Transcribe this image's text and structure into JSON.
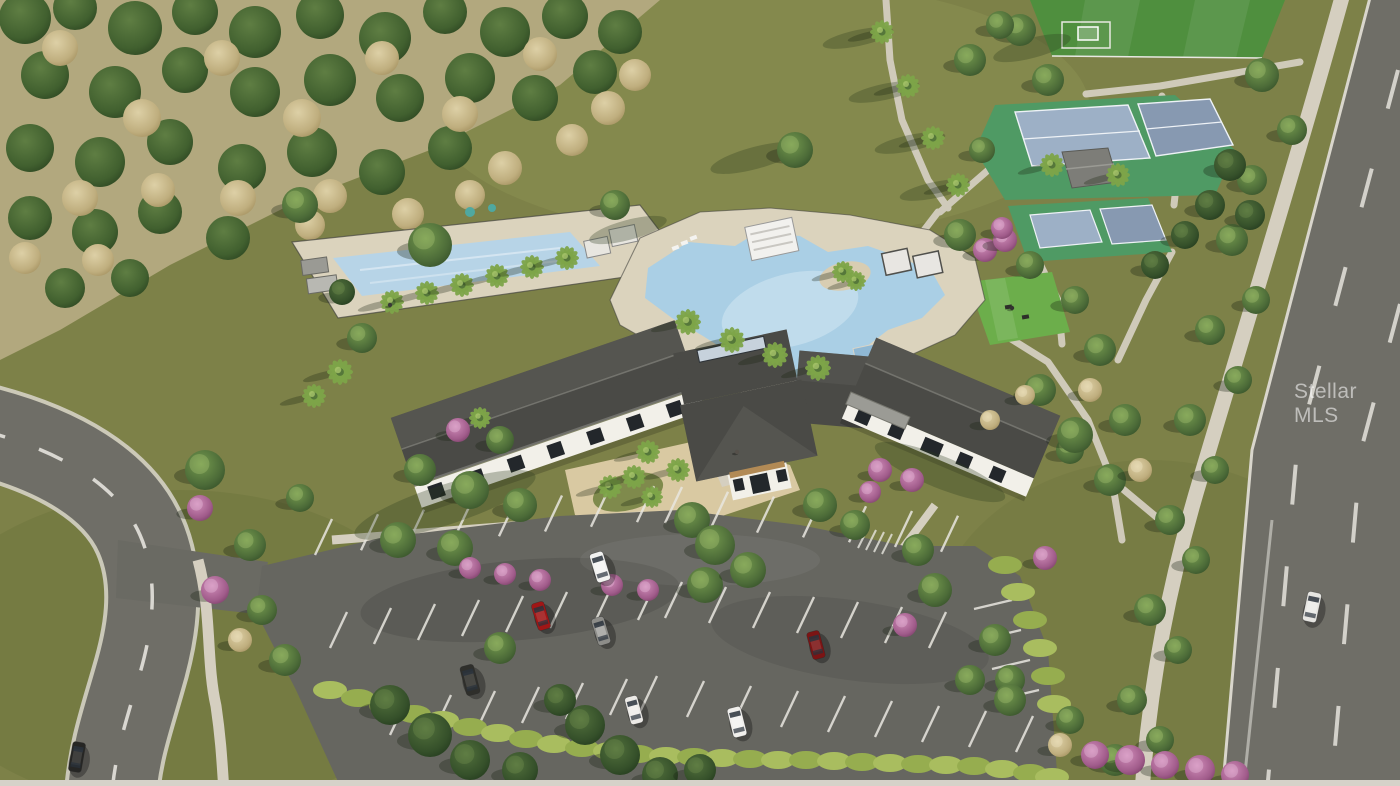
{
  "image": {
    "width": 1400,
    "height": 786,
    "kind": "aerial-3d-rendering",
    "subject": "community clubhouse amenity center with resort pool, lap pool, tennis and pickleball courts, event lawn, soccer field, parking lot and perimeter roads"
  },
  "watermark": {
    "text": "Stellar MLS",
    "color": "rgba(255,255,255,0.55)"
  },
  "palette": {
    "grassMeadow": "#7d8148",
    "grassLight": "#8b8f52",
    "grassDark": "#667039",
    "fieldGreen": "#4f8f3e",
    "lawnGreen": "#6cae4b",
    "courtGreen": "#4f9a64",
    "courtBlue": "#9db0c6",
    "courtBlueShade": "#8799b1",
    "scrubBase": "#b2a87e",
    "asphalt": "#666660",
    "roadAsphalt": "#6f6e67",
    "curb": "#d9d6cc",
    "concrete": "#d5cfc0",
    "pavers": "#d9c9a2",
    "deck": "#dbd3bd",
    "poolWater": "#aacfe5",
    "poolLight": "#cde3f0",
    "lapWater": "#b7d4e7",
    "roofDark": "#4a4a46",
    "roofLight": "#5f5f59",
    "ridgeLight": "#73736d",
    "wallWhite": "#f2f0e9",
    "windowDark": "#23272b",
    "stripeWhite": "#e9e7e0",
    "hedgeGreen": "#a9bd5f",
    "pinkBloom": "#b4679c",
    "bottomStrip": "#d6d2c9"
  },
  "scene": {
    "scrub": [
      [
        25,
        18,
        26,
        "sg"
      ],
      [
        75,
        8,
        22,
        "sg"
      ],
      [
        135,
        28,
        27,
        "sg"
      ],
      [
        195,
        12,
        23,
        "sg"
      ],
      [
        255,
        32,
        26,
        "sg"
      ],
      [
        320,
        15,
        24,
        "sg"
      ],
      [
        385,
        38,
        26,
        "sg"
      ],
      [
        445,
        12,
        22,
        "sg"
      ],
      [
        505,
        32,
        25,
        "sg"
      ],
      [
        565,
        16,
        23,
        "sg"
      ],
      [
        620,
        32,
        22,
        "sg"
      ],
      [
        45,
        75,
        24,
        "sg"
      ],
      [
        115,
        92,
        26,
        "sg"
      ],
      [
        185,
        70,
        23,
        "sg"
      ],
      [
        255,
        92,
        25,
        "sg"
      ],
      [
        330,
        80,
        26,
        "sg"
      ],
      [
        400,
        98,
        24,
        "sg"
      ],
      [
        470,
        78,
        25,
        "sg"
      ],
      [
        535,
        98,
        23,
        "sg"
      ],
      [
        595,
        72,
        22,
        "sg"
      ],
      [
        30,
        148,
        24,
        "sg"
      ],
      [
        100,
        162,
        25,
        "sg"
      ],
      [
        170,
        142,
        23,
        "sg"
      ],
      [
        242,
        168,
        24,
        "sg"
      ],
      [
        312,
        152,
        25,
        "sg"
      ],
      [
        382,
        172,
        23,
        "sg"
      ],
      [
        450,
        148,
        22,
        "sg"
      ],
      [
        30,
        218,
        22,
        "sg"
      ],
      [
        95,
        232,
        23,
        "sg"
      ],
      [
        160,
        212,
        22,
        "sg"
      ],
      [
        228,
        238,
        22,
        "sg"
      ],
      [
        65,
        288,
        20,
        "sg"
      ],
      [
        130,
        278,
        19,
        "sg"
      ],
      [
        60,
        48,
        18,
        "tan"
      ],
      [
        142,
        118,
        19,
        "tan"
      ],
      [
        222,
        58,
        18,
        "tan"
      ],
      [
        302,
        118,
        19,
        "tan"
      ],
      [
        382,
        58,
        17,
        "tan"
      ],
      [
        460,
        114,
        18,
        "tan"
      ],
      [
        540,
        54,
        17,
        "tan"
      ],
      [
        608,
        108,
        17,
        "tan"
      ],
      [
        80,
        198,
        18,
        "tan"
      ],
      [
        158,
        190,
        17,
        "tan"
      ],
      [
        238,
        198,
        18,
        "tan"
      ],
      [
        330,
        196,
        17,
        "tan"
      ],
      [
        408,
        214,
        16,
        "tan"
      ],
      [
        25,
        258,
        16,
        "tan"
      ],
      [
        98,
        260,
        16,
        "tan"
      ],
      [
        310,
        225,
        15,
        "tan"
      ],
      [
        505,
        168,
        17,
        "tan"
      ],
      [
        572,
        140,
        16,
        "tan"
      ],
      [
        635,
        75,
        16,
        "tan"
      ],
      [
        470,
        195,
        15,
        "tan"
      ]
    ],
    "trees": [
      [
        392,
        302,
        12,
        "p"
      ],
      [
        427,
        293,
        12,
        "p"
      ],
      [
        462,
        285,
        12,
        "p"
      ],
      [
        497,
        276,
        12,
        "p"
      ],
      [
        532,
        267,
        12,
        "p"
      ],
      [
        567,
        258,
        12,
        "p"
      ],
      [
        340,
        372,
        13,
        "p"
      ],
      [
        314,
        396,
        12,
        "p"
      ],
      [
        688,
        322,
        13,
        "p"
      ],
      [
        732,
        340,
        13,
        "p"
      ],
      [
        775,
        355,
        13,
        "p"
      ],
      [
        818,
        368,
        13,
        "p"
      ],
      [
        843,
        272,
        11,
        "p"
      ],
      [
        856,
        281,
        10,
        "p"
      ],
      [
        882,
        32,
        12,
        "p"
      ],
      [
        908,
        86,
        12,
        "p"
      ],
      [
        933,
        138,
        12,
        "p"
      ],
      [
        958,
        185,
        12,
        "p"
      ],
      [
        1052,
        165,
        12,
        "p"
      ],
      [
        1118,
        175,
        12,
        "p"
      ],
      [
        610,
        487,
        12,
        "p"
      ],
      [
        634,
        477,
        12,
        "p"
      ],
      [
        652,
        497,
        11,
        "p"
      ],
      [
        648,
        452,
        12,
        "p"
      ],
      [
        678,
        470,
        12,
        "p"
      ],
      [
        480,
        418,
        11,
        "p"
      ],
      [
        205,
        470,
        20,
        "t"
      ],
      [
        250,
        545,
        16,
        "t"
      ],
      [
        262,
        610,
        15,
        "t"
      ],
      [
        300,
        498,
        14,
        "t"
      ],
      [
        285,
        660,
        16,
        "t"
      ],
      [
        300,
        205,
        18,
        "t"
      ],
      [
        430,
        245,
        22,
        "t"
      ],
      [
        362,
        338,
        15,
        "t"
      ],
      [
        615,
        205,
        15,
        "t"
      ],
      [
        960,
        235,
        16,
        "t"
      ],
      [
        1030,
        265,
        14,
        "t"
      ],
      [
        1075,
        300,
        14,
        "t"
      ],
      [
        1100,
        350,
        16,
        "t"
      ],
      [
        1125,
        420,
        16,
        "t"
      ],
      [
        1070,
        450,
        14,
        "t"
      ],
      [
        1040,
        390,
        16,
        "t"
      ],
      [
        1075,
        435,
        18,
        "t"
      ],
      [
        1110,
        480,
        16,
        "t"
      ],
      [
        795,
        150,
        18,
        "t"
      ],
      [
        1020,
        30,
        16,
        "t"
      ],
      [
        1048,
        80,
        16,
        "t"
      ],
      [
        970,
        60,
        16,
        "t"
      ],
      [
        1000,
        25,
        14,
        "t"
      ],
      [
        982,
        150,
        13,
        "t"
      ],
      [
        1262,
        75,
        17,
        "t"
      ],
      [
        1292,
        130,
        15,
        "t"
      ],
      [
        1252,
        180,
        15,
        "t"
      ],
      [
        1232,
        240,
        16,
        "t"
      ],
      [
        1256,
        300,
        14,
        "t"
      ],
      [
        1210,
        330,
        15,
        "t"
      ],
      [
        1238,
        380,
        14,
        "t"
      ],
      [
        1190,
        420,
        16,
        "t"
      ],
      [
        1215,
        470,
        14,
        "t"
      ],
      [
        1170,
        520,
        15,
        "t"
      ],
      [
        1196,
        560,
        14,
        "t"
      ],
      [
        1150,
        610,
        16,
        "t"
      ],
      [
        1178,
        650,
        14,
        "t"
      ],
      [
        1132,
        700,
        15,
        "t"
      ],
      [
        1160,
        740,
        14,
        "t"
      ],
      [
        1115,
        760,
        16,
        "t"
      ],
      [
        398,
        540,
        18,
        "t"
      ],
      [
        455,
        548,
        18,
        "t"
      ],
      [
        692,
        520,
        18,
        "t"
      ],
      [
        705,
        585,
        18,
        "t"
      ],
      [
        918,
        550,
        16,
        "t"
      ],
      [
        935,
        590,
        17,
        "t"
      ],
      [
        995,
        640,
        16,
        "t"
      ],
      [
        1010,
        680,
        15,
        "t"
      ],
      [
        500,
        648,
        16,
        "t"
      ],
      [
        715,
        545,
        20,
        "t"
      ],
      [
        748,
        570,
        18,
        "t"
      ],
      [
        820,
        505,
        17,
        "t"
      ],
      [
        855,
        525,
        15,
        "t"
      ],
      [
        470,
        490,
        19,
        "t"
      ],
      [
        520,
        505,
        17,
        "t"
      ],
      [
        500,
        440,
        14,
        "t"
      ],
      [
        420,
        470,
        16,
        "t"
      ],
      [
        1010,
        700,
        16,
        "t"
      ],
      [
        970,
        680,
        15,
        "t"
      ],
      [
        1070,
        720,
        14,
        "t"
      ],
      [
        1230,
        165,
        16,
        "td"
      ],
      [
        1210,
        205,
        15,
        "td"
      ],
      [
        1185,
        235,
        14,
        "td"
      ],
      [
        1155,
        265,
        14,
        "td"
      ],
      [
        1250,
        215,
        15,
        "td"
      ],
      [
        390,
        705,
        20,
        "td"
      ],
      [
        430,
        735,
        22,
        "td"
      ],
      [
        470,
        760,
        20,
        "td"
      ],
      [
        520,
        770,
        18,
        "td"
      ],
      [
        585,
        725,
        20,
        "td"
      ],
      [
        620,
        755,
        20,
        "td"
      ],
      [
        660,
        775,
        18,
        "td"
      ],
      [
        700,
        770,
        16,
        "td"
      ],
      [
        560,
        700,
        16,
        "td"
      ],
      [
        342,
        292,
        13,
        "td"
      ],
      [
        200,
        508,
        13,
        "pk"
      ],
      [
        215,
        590,
        14,
        "pk"
      ],
      [
        458,
        430,
        12,
        "pk"
      ],
      [
        470,
        568,
        11,
        "pk"
      ],
      [
        505,
        574,
        11,
        "pk"
      ],
      [
        540,
        580,
        11,
        "pk"
      ],
      [
        612,
        585,
        11,
        "pk"
      ],
      [
        648,
        590,
        11,
        "pk"
      ],
      [
        880,
        470,
        12,
        "pk"
      ],
      [
        912,
        480,
        12,
        "pk"
      ],
      [
        870,
        492,
        11,
        "pk"
      ],
      [
        905,
        625,
        12,
        "pk"
      ],
      [
        1045,
        558,
        12,
        "pk"
      ],
      [
        985,
        250,
        12,
        "pk"
      ],
      [
        1005,
        240,
        12,
        "pk"
      ],
      [
        1002,
        228,
        11,
        "pk"
      ],
      [
        1095,
        755,
        14,
        "pk"
      ],
      [
        1130,
        760,
        15,
        "pk"
      ],
      [
        1165,
        765,
        14,
        "pk"
      ],
      [
        1200,
        770,
        15,
        "pk"
      ],
      [
        1235,
        775,
        14,
        "pk"
      ],
      [
        240,
        640,
        12,
        "tan"
      ],
      [
        1090,
        390,
        12,
        "tan"
      ],
      [
        1140,
        470,
        12,
        "tan"
      ],
      [
        1060,
        745,
        12,
        "tan"
      ],
      [
        1025,
        395,
        10,
        "tan"
      ],
      [
        990,
        420,
        10,
        "tan"
      ]
    ],
    "hedges": [
      [
        330,
        690
      ],
      [
        358,
        698
      ],
      [
        386,
        706
      ],
      [
        414,
        714
      ],
      [
        442,
        720
      ],
      [
        470,
        727
      ],
      [
        498,
        733
      ],
      [
        526,
        739
      ],
      [
        554,
        744
      ],
      [
        582,
        748
      ],
      [
        610,
        751
      ],
      [
        638,
        754
      ],
      [
        666,
        756
      ],
      [
        694,
        757
      ],
      [
        722,
        758
      ],
      [
        750,
        759
      ],
      [
        778,
        760
      ],
      [
        806,
        760
      ],
      [
        834,
        761
      ],
      [
        862,
        762
      ],
      [
        890,
        763
      ],
      [
        918,
        764
      ],
      [
        946,
        765
      ],
      [
        974,
        766
      ],
      [
        1002,
        769
      ],
      [
        1030,
        773
      ],
      [
        1052,
        777
      ],
      [
        1005,
        565
      ],
      [
        1018,
        592
      ],
      [
        1030,
        620
      ],
      [
        1040,
        648
      ],
      [
        1048,
        676
      ],
      [
        1054,
        704
      ]
    ],
    "shadows": [
      [
        858,
        38,
        36,
        8,
        -12
      ],
      [
        884,
        92,
        36,
        8,
        -12
      ],
      [
        910,
        143,
        36,
        8,
        -12
      ],
      [
        935,
        190,
        36,
        8,
        -12
      ],
      [
        755,
        158,
        46,
        11,
        -15
      ],
      [
        445,
        505,
        95,
        20,
        -18
      ],
      [
        940,
        472,
        70,
        16,
        22
      ],
      [
        628,
        230,
        40,
        10,
        -15
      ],
      [
        1032,
        48,
        40,
        10,
        -15
      ]
    ],
    "stripe_rows": [
      {
        "x": 315,
        "y": 555,
        "dx": 46,
        "dy": -4.7,
        "n": 8,
        "vx": 17,
        "vy": -36
      },
      {
        "x": 665,
        "y": 523,
        "dx": 46,
        "dy": 4.8,
        "n": 7,
        "vx": 17,
        "vy": -36
      },
      {
        "x": 330,
        "y": 648,
        "dx": 44,
        "dy": -4,
        "n": 8,
        "vx": 17,
        "vy": -36
      },
      {
        "x": 665,
        "y": 618,
        "dx": 44,
        "dy": 5,
        "n": 7,
        "vx": 17,
        "vy": -36
      },
      {
        "x": 390,
        "y": 735,
        "dx": 44,
        "dy": -4,
        "n": 6,
        "vx": 17,
        "vy": -36
      },
      {
        "x": 640,
        "y": 712,
        "dx": 47,
        "dy": 5,
        "n": 9,
        "vx": 17,
        "vy": -36
      },
      {
        "x": 1012,
        "y": 600,
        "dx": 9,
        "dy": 30,
        "n": 4,
        "vx": -38,
        "vy": 9
      }
    ],
    "cars": [
      {
        "x": 600,
        "y": 567,
        "rot": -17,
        "len": 30,
        "wid": 14,
        "color": "#f2f2f0"
      },
      {
        "x": 541,
        "y": 616,
        "rot": -17,
        "len": 28,
        "wid": 13,
        "color": "#a01616"
      },
      {
        "x": 601,
        "y": 631,
        "rot": -17,
        "len": 28,
        "wid": 13,
        "color": "#8d8d89"
      },
      {
        "x": 470,
        "y": 680,
        "rot": -15,
        "len": 30,
        "wid": 14,
        "color": "#2f2f2b"
      },
      {
        "x": 634,
        "y": 710,
        "rot": -15,
        "len": 28,
        "wid": 13,
        "color": "#eceae6"
      },
      {
        "x": 737,
        "y": 722,
        "rot": -14,
        "len": 30,
        "wid": 14,
        "color": "#f0efec"
      },
      {
        "x": 816,
        "y": 645,
        "rot": -15,
        "len": 28,
        "wid": 13,
        "color": "#7c1414"
      },
      {
        "x": 1312,
        "y": 607,
        "rot": 12,
        "len": 30,
        "wid": 14,
        "color": "#e6e5e1"
      },
      {
        "x": 77,
        "y": 757,
        "rot": 10,
        "len": 30,
        "wid": 13,
        "color": "#262624"
      }
    ],
    "people": [
      [
        390,
        305,
        "#3a3a38"
      ],
      [
        737,
        452,
        "#55504a"
      ],
      [
        1012,
        308,
        "#33332f"
      ]
    ]
  }
}
